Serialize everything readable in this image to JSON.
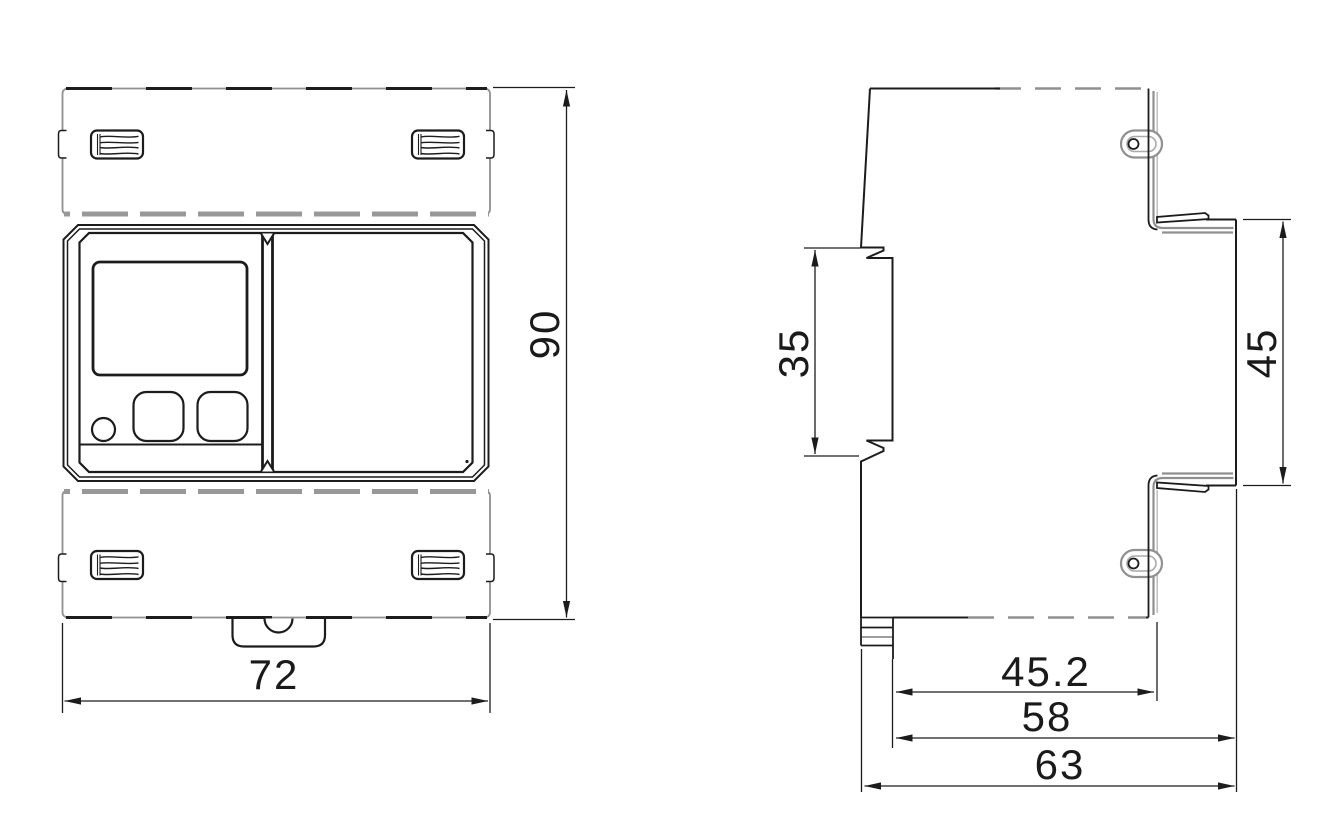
{
  "colors": {
    "line": "#1c1c1c",
    "cover_line": "#909090",
    "background": "#ffffff"
  },
  "dimensions": {
    "front": {
      "width": "72",
      "height": "90"
    },
    "side": {
      "rail_slot": "35",
      "front_height": "45",
      "rail_to_back": "45.2",
      "body_depth": "58",
      "total_depth": "63"
    }
  }
}
